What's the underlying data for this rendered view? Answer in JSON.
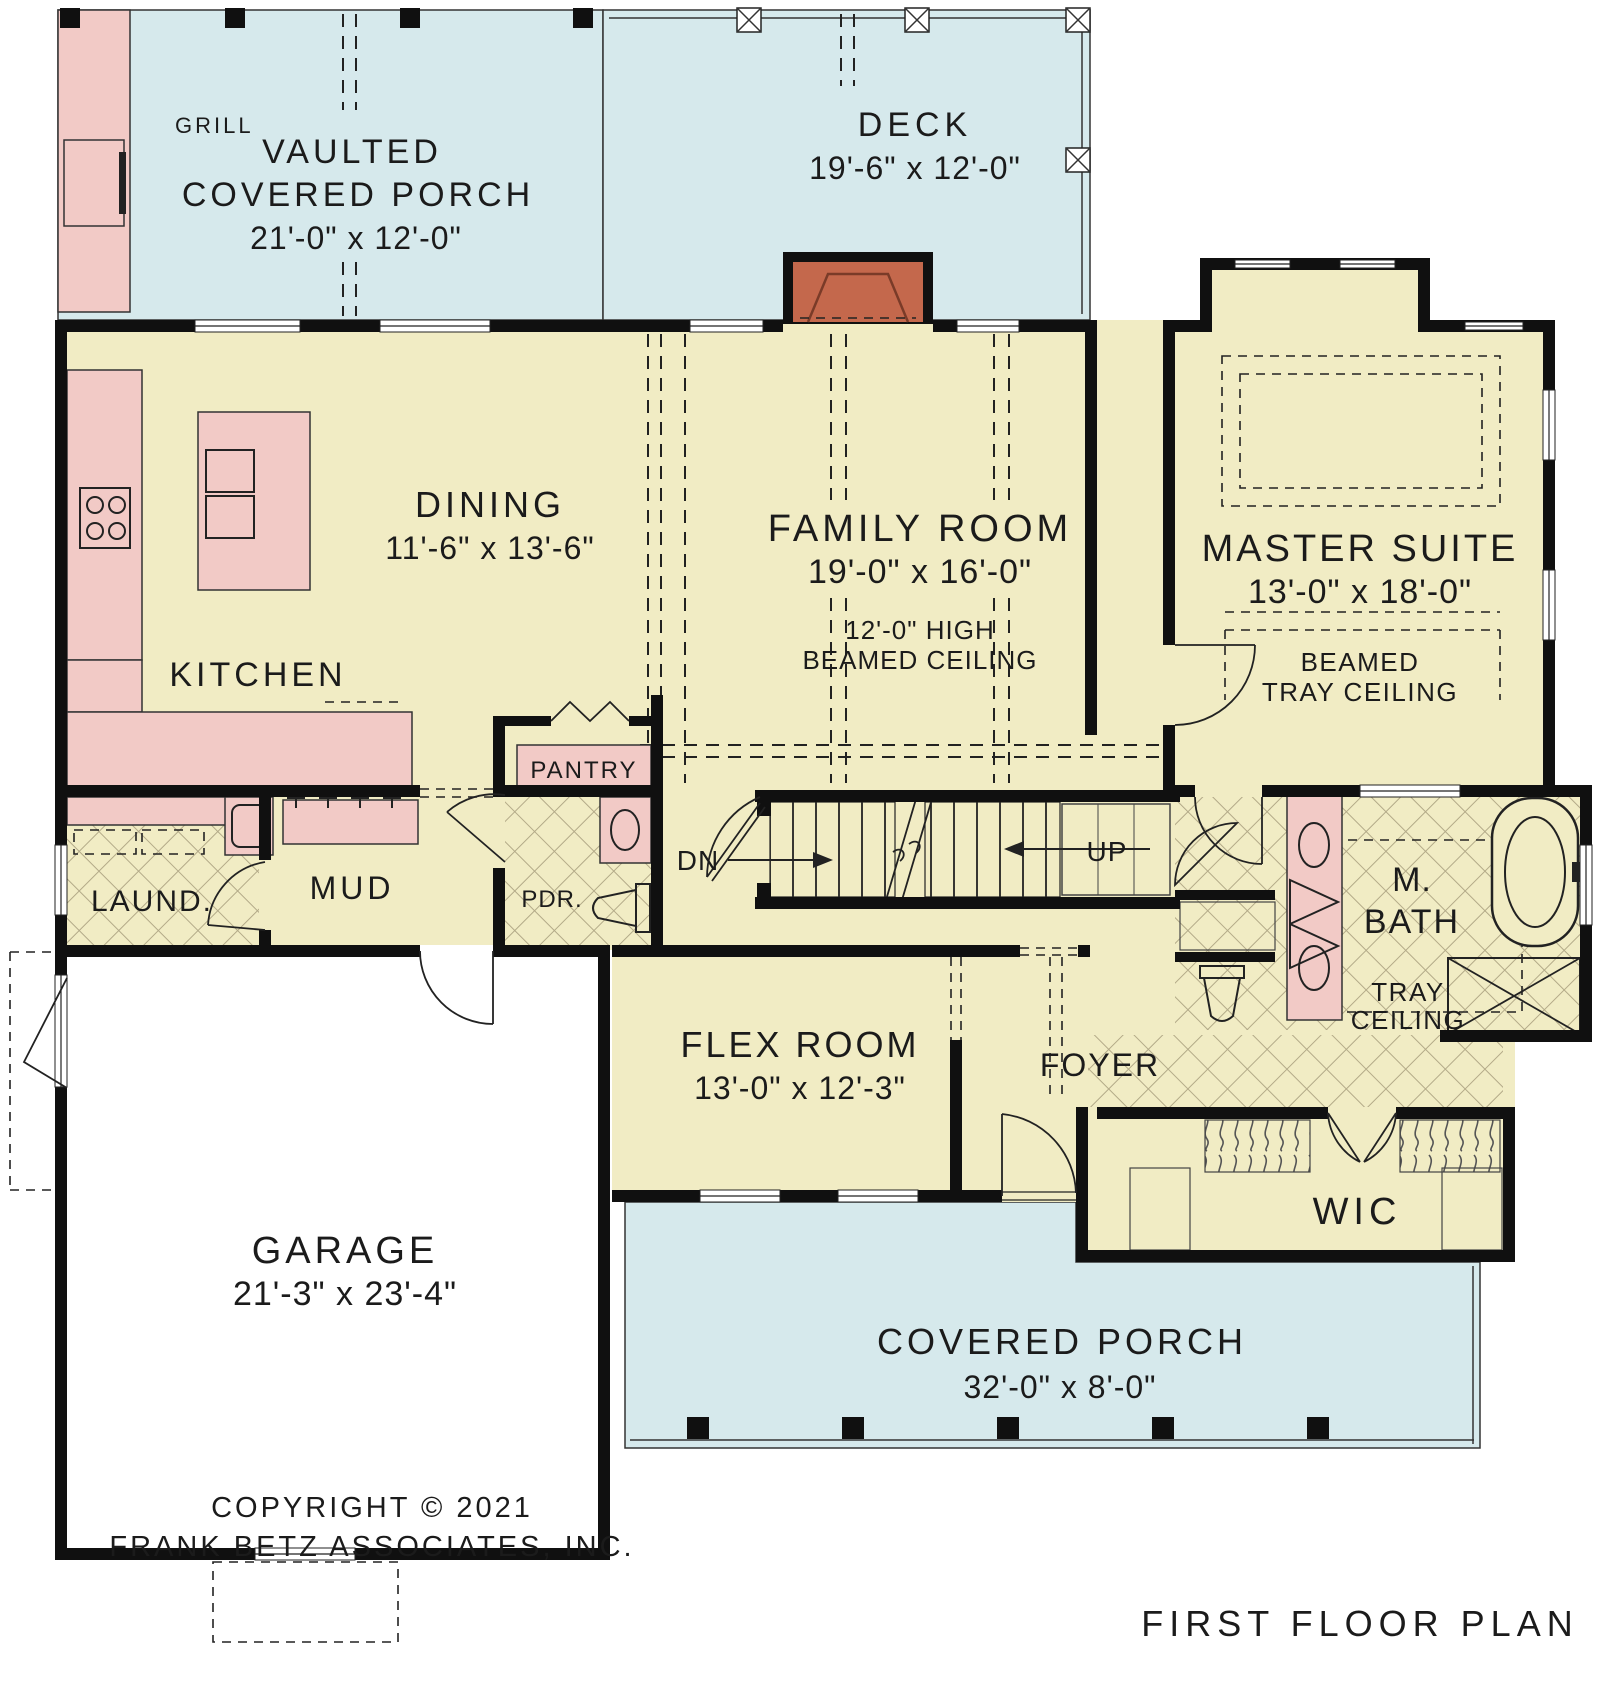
{
  "colors": {
    "porch_blue": "#d6e9ec",
    "interior_cream": "#f1ecc4",
    "fixture_pink": "#f2cac6",
    "fireplace_brick": "#c4684c",
    "wall_black": "#101010"
  },
  "plan": {
    "grill": "GRILL",
    "vaulted_porch_l1": "VAULTED",
    "vaulted_porch_l2": "COVERED PORCH",
    "vaulted_porch_dims": "21'-0\" x 12'-0\"",
    "deck": "DECK",
    "deck_dims": "19'-6\" x 12'-0\"",
    "dining": "DINING",
    "dining_dims": "11'-6\" x 13'-6\"",
    "kitchen": "KITCHEN",
    "family": "FAMILY ROOM",
    "family_dims": "19'-0\" x 16'-0\"",
    "family_note1": "12'-0\" HIGH",
    "family_note2": "BEAMED CEILING",
    "master": "MASTER SUITE",
    "master_dims": "13'-0\" x 18'-0\"",
    "master_note1": "BEAMED",
    "master_note2": "TRAY CEILING",
    "pantry": "PANTRY",
    "pdr": "PDR.",
    "mud": "MUD",
    "laundry": "LAUND.",
    "dn": "DN",
    "up": "UP",
    "mbath_l1": "M.",
    "mbath_l2": "BATH",
    "mbath_note1": "TRAY",
    "mbath_note2": "CEILING",
    "flex": "FLEX ROOM",
    "flex_dims": "13'-0\" x 12'-3\"",
    "foyer": "FOYER",
    "wic": "WIC",
    "garage": "GARAGE",
    "garage_dims": "21'-3\" x 23'-4\"",
    "front_porch": "COVERED PORCH",
    "front_porch_dims": "32'-0\" x 8'-0\"",
    "copyright_line1": "COPYRIGHT © 2021",
    "copyright_line2": "FRANK BETZ ASSOCIATES, INC.",
    "title": "FIRST FLOOR PLAN"
  }
}
